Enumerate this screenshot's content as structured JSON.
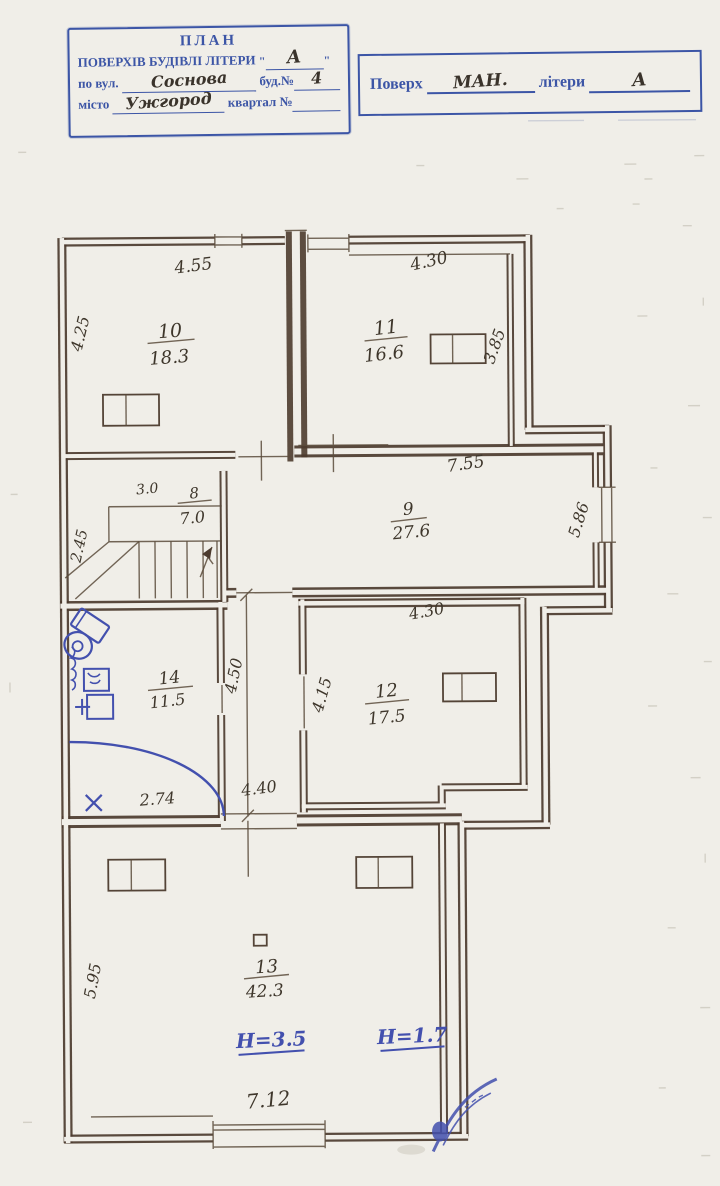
{
  "stamp": {
    "title": "ПЛАН",
    "row1_label": "ПОВЕРХІВ БУДІВЛІ ЛІТЕРИ",
    "row1_quote_open": "\"",
    "row1_value": "А",
    "row1_quote_close": "\"",
    "row2_label": "по вул.",
    "row2_value": "Соснова",
    "row2_label2": "буд.№",
    "row2_value2": "4",
    "row3_label": "місто",
    "row3_value": "Ужгород",
    "row3_label2": "квартал №"
  },
  "floor_box": {
    "label1": "Поверх",
    "value1": "МАН.",
    "label2": "літери",
    "value2": "А"
  },
  "plan": {
    "rooms": {
      "r8": {
        "number": "8",
        "area": "7.0"
      },
      "r9": {
        "number": "9",
        "area": "27.6"
      },
      "r10": {
        "number": "10",
        "area": "18.3"
      },
      "r11": {
        "number": "11",
        "area": "16.6"
      },
      "r12": {
        "number": "12",
        "area": "17.5"
      },
      "r13": {
        "number": "13",
        "area": "42.3"
      },
      "r14": {
        "number": "14",
        "area": "11.5"
      }
    },
    "dims": {
      "room10_top": "4.55",
      "room10_left": "4.25",
      "room11_top": "4.30",
      "room11_right": "3.85",
      "room9_top": "7.55",
      "room9_right": "5.86",
      "stairs_width": "3.0",
      "stairs_left": "2.45",
      "corridor_vertical": "4.50",
      "corridor_horizontal": "4.40",
      "room12_top": "4.30",
      "room12_left": "4.15",
      "room14_bottom": "2.74",
      "room13_left": "5.95",
      "room13_bottom": "7.12"
    },
    "heights": {
      "main": "Н=3.5",
      "low": "Н=1.7"
    }
  }
}
